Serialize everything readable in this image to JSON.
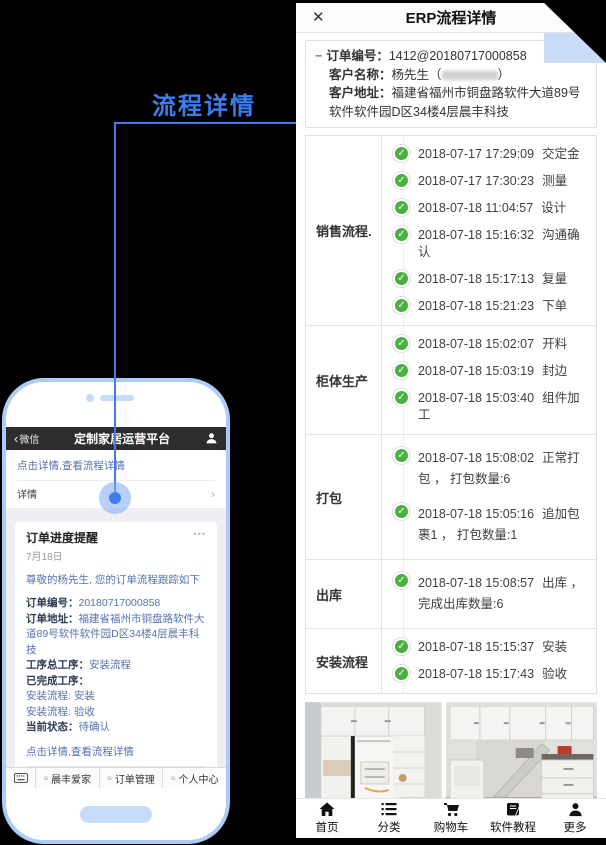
{
  "annotation": {
    "title": "流程详情"
  },
  "colors": {
    "accent_blue": "#3e7df0",
    "check_green": "#4caf43",
    "fold_blue": "#c9dcf7",
    "phone_border": "#a9cdf8",
    "link_blue": "#5672ae"
  },
  "phone": {
    "navbar": {
      "back_chevron": "‹",
      "back_label": "微信",
      "title": "定制家居运营平台"
    },
    "card_top": {
      "link": "点击详情,查看流程详情",
      "detail_label": "详情",
      "chevron": "›"
    },
    "notification": {
      "title": "订单进度提醒",
      "menu_dots": "•••",
      "date": "7月18日",
      "greeting": "尊敬的杨先生, 您的订单流程跟踪如下",
      "fields": [
        {
          "label": "订单编号：",
          "value": "20180717000858"
        },
        {
          "label": "订单地址：",
          "value": "福建省福州市铜盘路软件大道89号软件软件园D区34楼4层晨丰科技"
        },
        {
          "label": "工序总工序：",
          "value": "安装流程"
        },
        {
          "label": "已完成工序：",
          "value": ""
        },
        {
          "label": "",
          "value": "安装流程: 安装"
        },
        {
          "label": "",
          "value": "安装流程: 验收"
        },
        {
          "label": "当前状态：",
          "value": "待确认"
        }
      ],
      "link": "点击详情,查看流程详情",
      "detail_label": "详情",
      "chevron": "›"
    },
    "next_card": {
      "title": "订单进度提醒",
      "menu_dots": "•••"
    },
    "menubar": {
      "items": [
        "晨丰爱家",
        "订单管理",
        "个人中心"
      ],
      "eq": "≡"
    }
  },
  "erp": {
    "header": {
      "title": "ERP流程详情",
      "close": "✕"
    },
    "order_info": {
      "minus": "−",
      "rows": [
        {
          "label": "订单编号：",
          "value": "1412@20180717000858"
        },
        {
          "label": "客户名称：",
          "value_prefix": "杨先生（",
          "value_suffix": "）"
        },
        {
          "label": "客户地址：",
          "value": "福建省福州市铜盘路软件大道89号软件软件园D区34楼4层晨丰科技"
        }
      ]
    },
    "process": {
      "check_glyph": "✓",
      "sections": [
        {
          "label": "销售流程.",
          "items": [
            {
              "time": "2018-07-17 17:29:09",
              "action": "交定金"
            },
            {
              "time": "2018-07-17 17:30:23",
              "action": "测量"
            },
            {
              "time": "2018-07-18 11:04:57",
              "action": "设计"
            },
            {
              "time": "2018-07-18 15:16:32",
              "action": "沟通确认"
            },
            {
              "time": "2018-07-18 15:17:13",
              "action": "复量"
            },
            {
              "time": "2018-07-18 15:21:23",
              "action": "下单"
            }
          ]
        },
        {
          "label": "柜体生产",
          "items": [
            {
              "time": "2018-07-18 15:02:07",
              "action": "开料"
            },
            {
              "time": "2018-07-18 15:03:19",
              "action": "封边"
            },
            {
              "time": "2018-07-18 15:03:40",
              "action": "组件加工"
            }
          ]
        },
        {
          "label": "打包",
          "items": [
            {
              "time": "2018-07-18 15:08:02",
              "action": "正常打包 ， 打包数量:6"
            },
            {
              "time": "2018-07-18 15:05:16",
              "action": "追加包裹1 ， 打包数量:1"
            }
          ]
        },
        {
          "label": "出库",
          "items": [
            {
              "time": "2018-07-18 15:08:57",
              "action": "出库 ， 完成出库数量:6"
            }
          ]
        },
        {
          "label": "安装流程",
          "items": [
            {
              "time": "2018-07-18 15:15:37",
              "action": "安装"
            },
            {
              "time": "2018-07-18 15:17:43",
              "action": "验收"
            }
          ]
        }
      ]
    },
    "footer": {
      "copyright": "Copyright ©  晨丰全屋定制商城  闽ICP备16007300号-",
      "top_arrow": "↑",
      "top_label": "顶部"
    },
    "nav": {
      "items": [
        {
          "label": "首页"
        },
        {
          "label": "分类"
        },
        {
          "label": "购物车"
        },
        {
          "label": "软件教程"
        },
        {
          "label": "更多"
        }
      ]
    }
  }
}
